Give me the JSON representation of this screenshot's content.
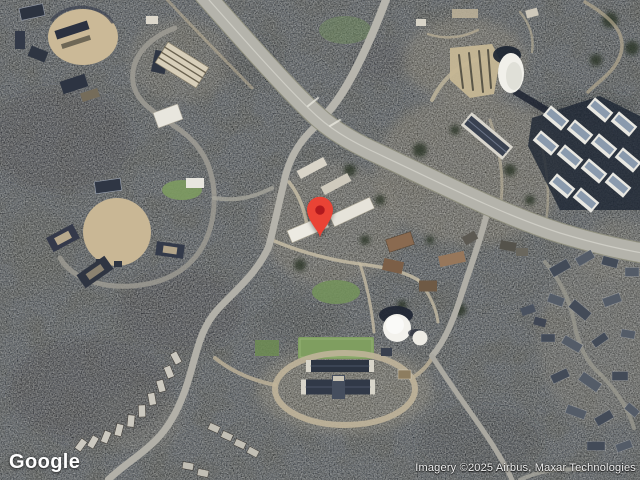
{
  "map": {
    "view_type": "satellite",
    "provider_logo": "Google",
    "attribution": "Imagery ©2025 Airbus, Maxar Technologies",
    "marker": {
      "color": "#EA4335",
      "dot_color": "#B0191E",
      "tip_x": 320,
      "tip_y": 239
    },
    "palette": {
      "forest_base": "#434741",
      "forest_shadow": "#1f2734",
      "scrub_tan": "#a89d85",
      "road_gray": "#b2b1a9",
      "building_white": "#eceae2",
      "field_green": "#7f9e60",
      "roof_dark": "#313948",
      "roof_brown": "#8a6a50"
    }
  }
}
